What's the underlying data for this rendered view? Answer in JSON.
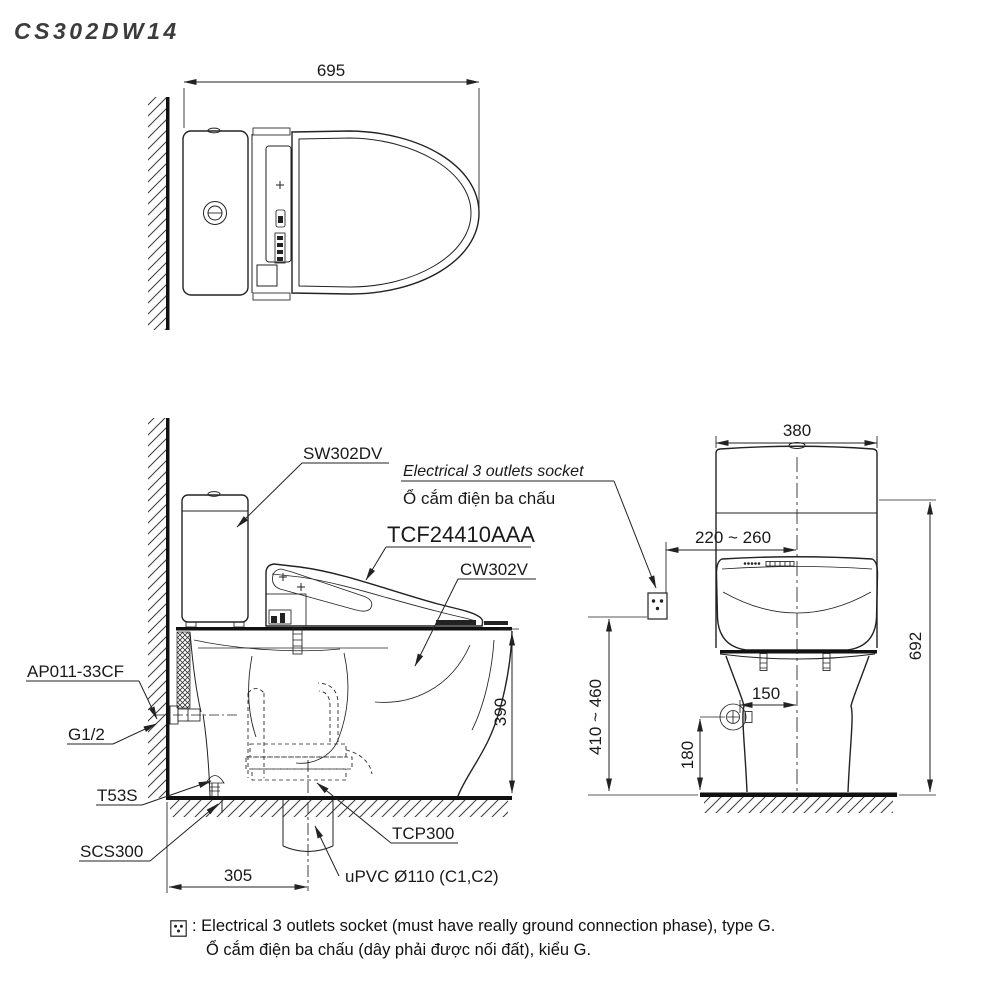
{
  "title": "CS302DW14",
  "colors": {
    "line": "#222222",
    "band": "#111111",
    "text": "#1a1a1a",
    "title_text": "#3c3c3c",
    "background": "#ffffff"
  },
  "top_view": {
    "dim_width": "695"
  },
  "side_view": {
    "label_cistern": "SW302DV",
    "label_socket_en": "Electrical 3 outlets socket",
    "label_socket_vi": "Ổ cắm điện ba chấu",
    "label_seat_unit": "TCF24410AAA",
    "label_bowl": "CW302V",
    "label_supply_hose": "AP011-33CF",
    "label_supply_thread": "G1/2",
    "label_angle_valve": "T53S",
    "label_floor_set": "SCS300",
    "label_trap_adapter": "TCP300",
    "label_drain_pipe": "uPVC Ø110 (C1,C2)",
    "dim_rough_in": "305",
    "dim_rim_height": "390"
  },
  "front_view": {
    "dim_width": "380",
    "dim_socket_offset": "220 ~ 260",
    "dim_total_height": "692",
    "dim_socket_height": "410 ~ 460",
    "dim_valve_offset": "150",
    "dim_valve_height": "180"
  },
  "footnote": {
    "line1": ": Electrical 3 outlets socket (must have really ground connection phase), type G.",
    "line2": "Ổ cắm điện ba chấu (dây phải được nối đất), kiểu G."
  }
}
